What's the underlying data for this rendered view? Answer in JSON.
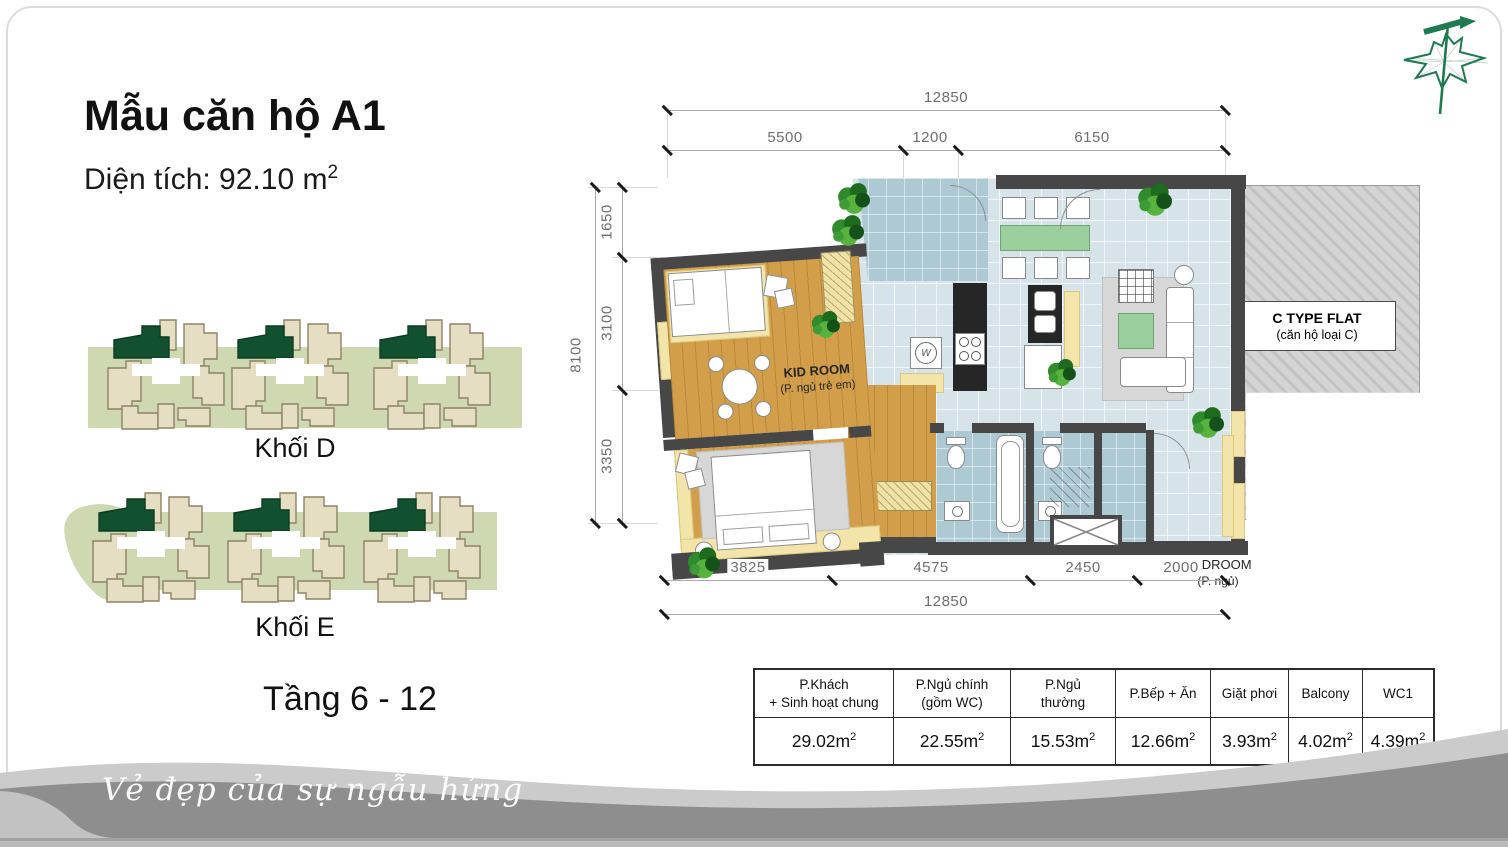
{
  "header": {
    "title": "Mẫu căn hộ A1",
    "area_label": "Diện tích: 92.10 m",
    "area_sup": "2"
  },
  "blocks": {
    "block_d_label": "Khối D",
    "block_e_label": "Khối E",
    "floors_label": "Tầng 6 - 12"
  },
  "plan": {
    "dims_top_total": "12850",
    "dims_top": [
      "5500",
      "1200",
      "6150"
    ],
    "dims_left_total": "8100",
    "dims_left": [
      "1650",
      "3100",
      "3350"
    ],
    "dims_bottom": [
      "3825",
      "4575",
      "2450",
      "2000"
    ],
    "dims_bottom_total": "12850",
    "labels": {
      "kid_room": "KID ROOM",
      "kid_room_sub": "(P. ngủ trẻ em)",
      "c_flat": "C TYPE FLAT",
      "c_flat_sub": "(căn hộ loại C)",
      "bedroom": "BEDROOM",
      "bedroom_sub": "(P. ngủ)",
      "washer": "W"
    }
  },
  "area_table": {
    "columns": [
      {
        "l1": "P.Khách",
        "l2": "+ Sinh hoạt chung",
        "value": "29.02m",
        "sup": "2"
      },
      {
        "l1": "P.Ngủ chính",
        "l2": "(gồm WC)",
        "value": "22.55m",
        "sup": "2"
      },
      {
        "l1": "P.Ngủ",
        "l2": "thường",
        "value": "15.53m",
        "sup": "2"
      },
      {
        "l1": "P.Bếp + Ăn",
        "l2": "",
        "value": "12.66m",
        "sup": "2"
      },
      {
        "l1": "Giặt phơi",
        "l2": "",
        "value": "3.93m",
        "sup": "2"
      },
      {
        "l1": "Balcony",
        "l2": "",
        "value": "4.02m",
        "sup": "2"
      },
      {
        "l1": "WC1",
        "l2": "",
        "value": "4.39m",
        "sup": "2"
      }
    ]
  },
  "footer": {
    "slogan": "Vẻ đẹp của sự ngẫu hứng"
  },
  "colors": {
    "brand_green": "#1e7a4f",
    "highlight_unit": "#11512f",
    "band_green": "#cfd9b1",
    "unit_beige": "#e6dec3",
    "wood": "#d29e49",
    "tile": "#d6e3e8",
    "balcony_tile": "#adc9d3",
    "wall": "#474747",
    "sill_yellow": "#f3e5aa",
    "table_green": "#9ccf9e",
    "footer_dark": "#8e8e8e",
    "footer_light": "#cbcbcb"
  }
}
